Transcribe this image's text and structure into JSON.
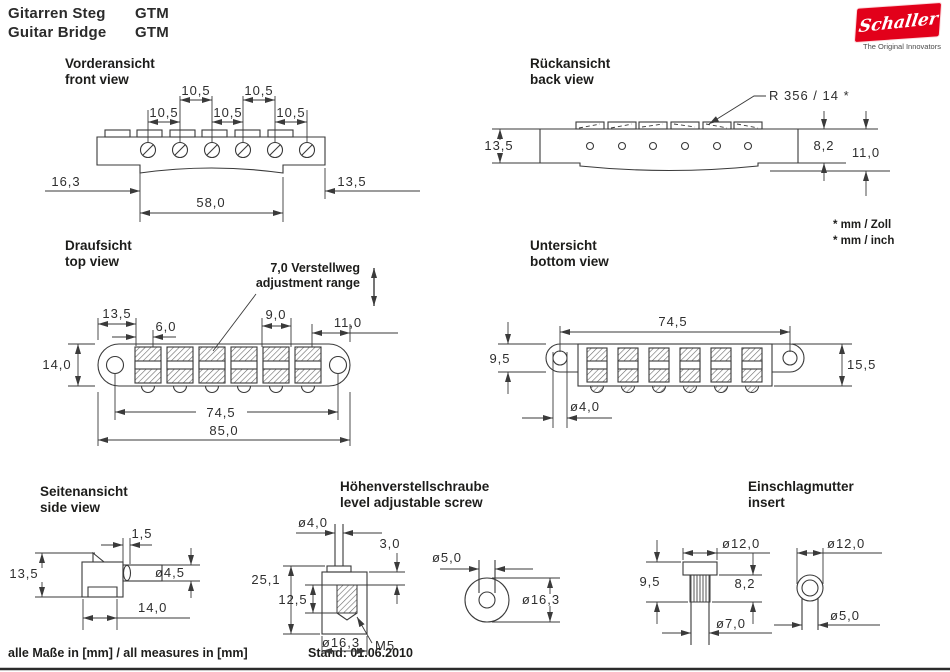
{
  "header": {
    "product_de": "Gitarren Steg",
    "product_en": "Guitar Bridge",
    "model": "GTM"
  },
  "logo": {
    "brand": "Schaller",
    "tagline": "The Original Innovators",
    "brand_color": "#e2001a"
  },
  "views": {
    "front": {
      "title_de": "Vorderansicht",
      "title_en": "front view",
      "dims": {
        "string_spacing": "10,5",
        "left_offset": "16,3",
        "right_offset": "13,5",
        "span": "58,0"
      }
    },
    "back": {
      "title_de": "Rückansicht",
      "title_en": "back view",
      "dims": {
        "radius": "R 356 / 14 *",
        "height": "13,5",
        "step": "8,2",
        "total_height": "11,0"
      },
      "notes": {
        "line1": "* mm / Zoll",
        "line2": "* mm / inch"
      }
    },
    "top": {
      "title_de": "Draufsicht",
      "title_en": "top view",
      "annotation_de": "7,0 Verstellweg",
      "annotation_en": "adjustment range",
      "dims": {
        "end_offset": "13,5",
        "saddle_width": "6,0",
        "saddle_len": "9,0",
        "right_offset": "11,0",
        "body_width": "14,0",
        "hole_span": "74,5",
        "total_length": "85,0"
      }
    },
    "bottom": {
      "title_de": "Untersicht",
      "title_en": "bottom view",
      "dims": {
        "hole_span": "74,5",
        "lobe_height": "9,5",
        "body_height": "15,5",
        "hole_dia": "ø4,0"
      }
    },
    "side": {
      "title_de": "Seitenansicht",
      "title_en": "side view",
      "dims": {
        "pin_offset": "1,5",
        "height": "13,5",
        "pin_dia": "ø4,5",
        "depth": "14,0"
      }
    },
    "screw": {
      "title_de": "Höhenverstellschraube",
      "title_en": "level adjustable screw",
      "dims": {
        "shaft_dia": "ø4,0",
        "collar": "3,0",
        "total_height": "25,1",
        "thread_depth": "12,5",
        "body_dia": "ø16,3",
        "thread": "M5",
        "top_shaft_dia": "ø5,0",
        "top_body_dia": "ø16,3"
      }
    },
    "insert": {
      "title_de": "Einschlagmutter",
      "title_en": "insert",
      "dims": {
        "cap_dia": "ø12,0",
        "height": "9,5",
        "knurl_height": "8,2",
        "shaft_dia": "ø7,0",
        "top_cap_dia": "ø12,0",
        "top_hole_dia": "ø5,0"
      }
    }
  },
  "footer": {
    "measures": "alle Maße in [mm] / all measures in [mm]",
    "date": "Stand: 01.06.2010"
  }
}
